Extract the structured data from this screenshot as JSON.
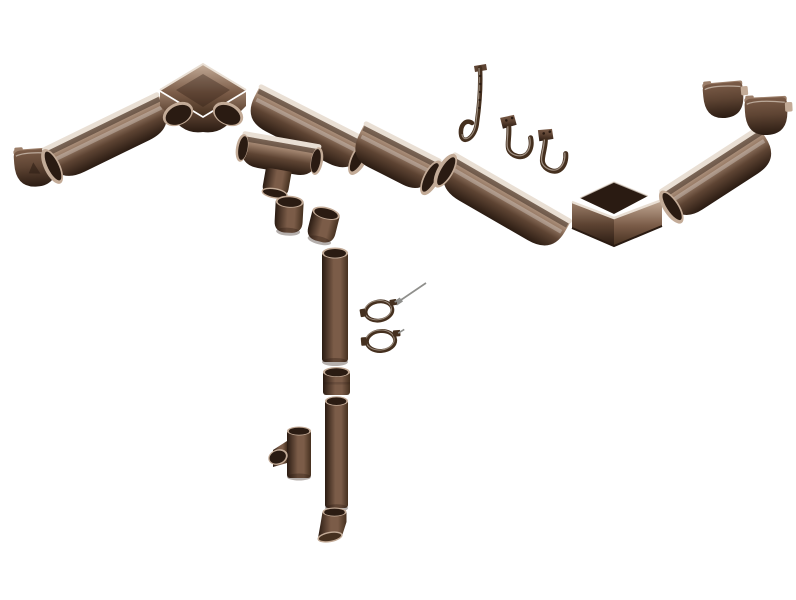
{
  "canvas": {
    "width": 796,
    "height": 600,
    "background": "#ffffff"
  },
  "palette": {
    "bg": "#ffffff",
    "brown-darkest": "#2a1b12",
    "brown-dark": "#45301f",
    "brown-mid": "#5e4433",
    "brown-soft": "#7b5c48",
    "brown-light": "#9c7f6a",
    "tan": "#c3ab97",
    "sheen": "#e9dfd4",
    "metal": "#8f8f8c"
  },
  "scene": {
    "kind": "exploded-view-product-render",
    "subject": "rain-gutter-downpipe-system",
    "part_count": 24,
    "parts": [
      "gutter-end-cap-left",
      "gutter-section-1",
      "gutter-inside-corner",
      "gutter-section-2",
      "gutter-outlet-funnel",
      "downpipe-elbow-1",
      "downpipe-elbow-2",
      "gutter-section-3",
      "rafter-strap-hanger",
      "gutter-hook-1",
      "gutter-hook-2",
      "gutter-section-4",
      "gutter-outside-corner",
      "gutter-section-5",
      "gutter-end-cap-right-1",
      "gutter-end-cap-right-2",
      "downpipe-upper",
      "mounting-screw",
      "pipe-clamp-1",
      "pipe-clamp-2",
      "pipe-coupler",
      "downpipe-lower",
      "downpipe-tee",
      "downpipe-shoe"
    ]
  }
}
